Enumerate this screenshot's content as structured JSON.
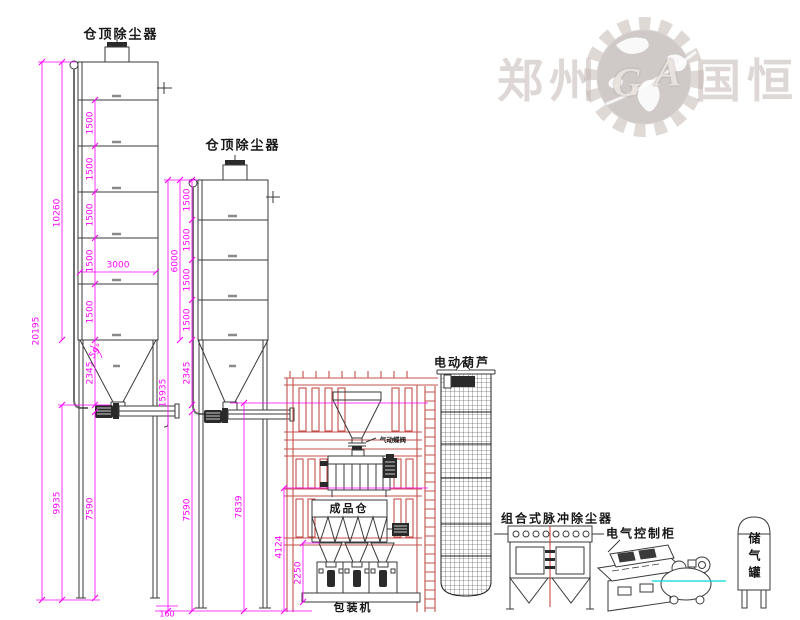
{
  "watermark": {
    "left": "郑州",
    "right": "国恒",
    "letter_g": "G",
    "letter_a": "A"
  },
  "labels": {
    "silo1_top_collector": "仓顶除尘器",
    "silo2_top_collector": "仓顶除尘器",
    "electric_hoist": "电动葫芦",
    "pneumatic_valve": "气动蝶阀",
    "product_bin": "成品仓",
    "packing_machine": "包装机",
    "pulse_dust_collector": "组合式脉冲除尘器",
    "electric_control_cabinet": "电气控制柜",
    "air_storage_tank": "储气罐"
  },
  "dimensions": {
    "silo1": {
      "total_height": "20195",
      "body_height": "10260",
      "segments": [
        "1500",
        "1500",
        "1500",
        "1500",
        "1500"
      ],
      "cone_height": "2345",
      "below_body": "9935",
      "leg_height": "7590",
      "diameter": "3000",
      "cone_angle": "59°"
    },
    "silo2": {
      "total_height": "15935",
      "body_height": "6000",
      "segments": [
        "1500",
        "1500",
        "1500",
        "1500"
      ],
      "cone_height": "2345",
      "leg_height": "7590",
      "discharge_height": "7839",
      "aux_height": "4124",
      "base_offset": "160"
    },
    "packer_height": "2250"
  },
  "colors": {
    "dimension_magenta": "#ff00ff",
    "frame_red": "#c4504c",
    "drawing_line": "#3a3a3a",
    "centerline_cyan": "#00d8d8",
    "collector_centerline": "#cc3333",
    "watermark_gray": "#c3b8b3"
  }
}
